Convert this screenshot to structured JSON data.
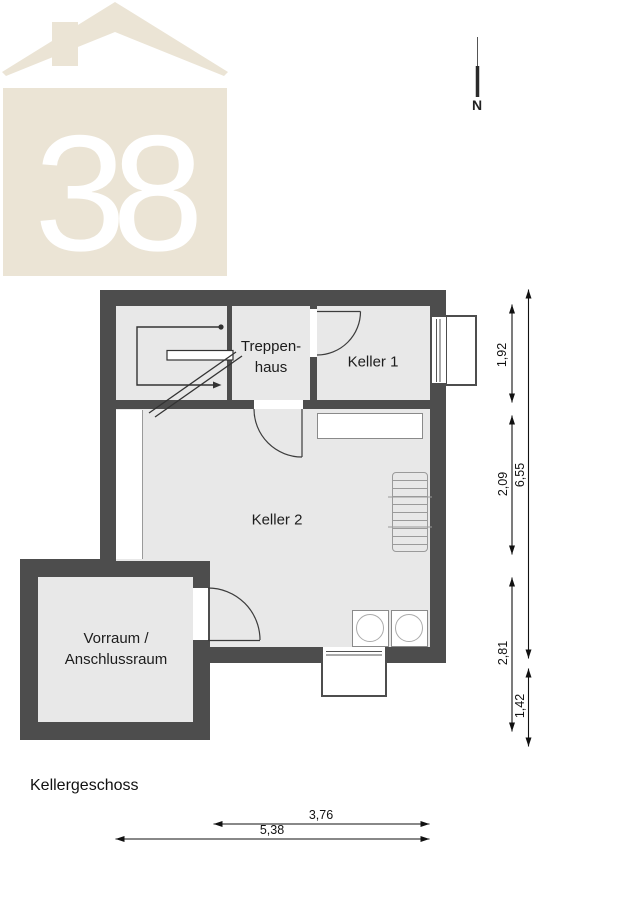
{
  "title": "Kellergeschoss",
  "north": {
    "label": "N"
  },
  "logo": {
    "number": "38"
  },
  "rooms": {
    "treppenhaus": {
      "line1": "Treppen-",
      "line2": "haus"
    },
    "keller1": {
      "label": "Keller 1"
    },
    "keller2": {
      "label": "Keller 2"
    },
    "vorraum": {
      "line1": "Vorraum /",
      "line2": "Anschlussraum"
    }
  },
  "dimensions": {
    "right_inner": [
      "1,92",
      "2,09",
      "2,81"
    ],
    "right_outer": [
      "6,55",
      "1,42"
    ],
    "bottom": [
      "3,76",
      "5,38"
    ]
  },
  "colors": {
    "wall": "#4d4d4d",
    "floor": "#e8e8e8",
    "logo-beige": "#ebe4d5",
    "line": "#333333"
  }
}
